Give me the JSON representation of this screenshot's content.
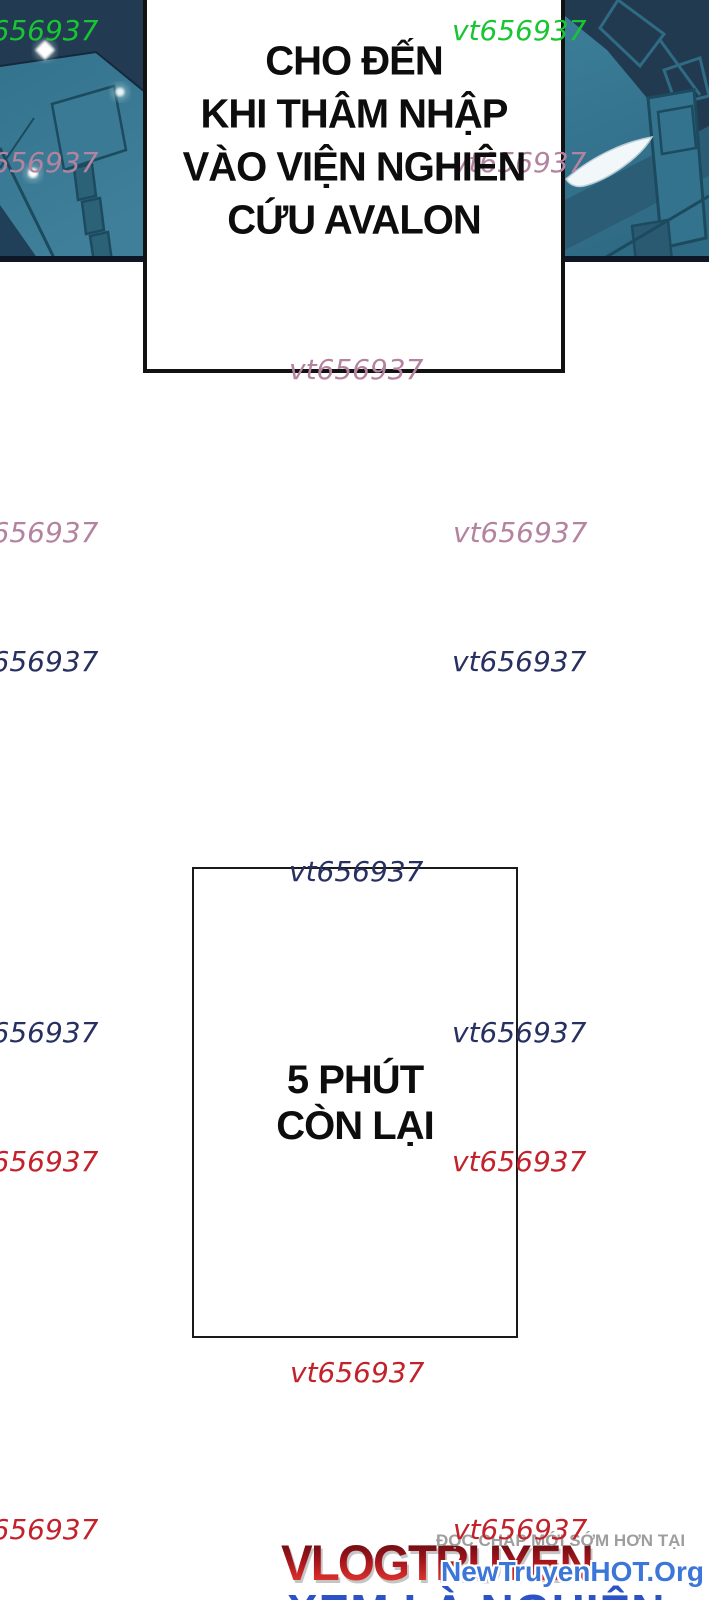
{
  "page": {
    "width": 709,
    "height": 1600,
    "background": "#ffffff"
  },
  "speech_bubble": {
    "lines": [
      "CHO ĐẾN",
      "KHI THÂM NHẬP",
      "VÀO VIỆN NGHIÊN",
      "CỨU AVALON"
    ],
    "text_color": "#0d0d0d"
  },
  "timer_panel": {
    "lines": [
      "5 PHÚT",
      "CÒN LẠI"
    ],
    "text_color": "#0d0d0d"
  },
  "watermark": {
    "text": "vt656937",
    "colors": {
      "green": "#18c532",
      "pink": "#b4839f",
      "navy": "#273060",
      "red": "#c2222b"
    },
    "items": [
      {
        "color": "green",
        "x": -36,
        "y": 13
      },
      {
        "color": "green",
        "x": 452,
        "y": 13
      },
      {
        "color": "pink",
        "x": -36,
        "y": 145
      },
      {
        "color": "pink",
        "x": 452,
        "y": 145
      },
      {
        "color": "pink",
        "x": 289,
        "y": 352
      },
      {
        "color": "pink",
        "x": -36,
        "y": 515
      },
      {
        "color": "pink",
        "x": 453,
        "y": 515
      },
      {
        "color": "navy",
        "x": -36,
        "y": 644
      },
      {
        "color": "navy",
        "x": 452,
        "y": 644
      },
      {
        "color": "navy",
        "x": 289,
        "y": 854
      },
      {
        "color": "navy",
        "x": -36,
        "y": 1015
      },
      {
        "color": "navy",
        "x": 452,
        "y": 1015
      },
      {
        "color": "red",
        "x": -36,
        "y": 1144
      },
      {
        "color": "red",
        "x": 452,
        "y": 1144
      },
      {
        "color": "red",
        "x": 290,
        "y": 1355
      },
      {
        "color": "red",
        "x": -36,
        "y": 1512
      },
      {
        "color": "red",
        "x": 453,
        "y": 1512
      }
    ]
  },
  "branding": {
    "tagline": "ĐỌC CHAP MỚI SỚM HƠN TẠI",
    "logo": "VLOGTRUYEN",
    "url": "NewTruyenHOT.Org",
    "slogan": "XEM LÀ NGHIỆN",
    "tagline_color": "#9e9e9e",
    "logo_gradient": [
      "#5e0c10",
      "#a3151b",
      "#ef3a33"
    ],
    "url_color": "#3c76d8",
    "slogan_color": "#2d52c8"
  },
  "artwork": {
    "description": "teal and navy mecha close-up comic art flanking the speech bubble",
    "palette": {
      "teal": "#35718b",
      "teal_light": "#44829c",
      "teal_dark": "#2b5d76",
      "navy": "#223a50",
      "line": "#1c4a5f",
      "blade": "#f2f7f9",
      "glow": "#ffffff",
      "frame": "#0e1725"
    }
  }
}
